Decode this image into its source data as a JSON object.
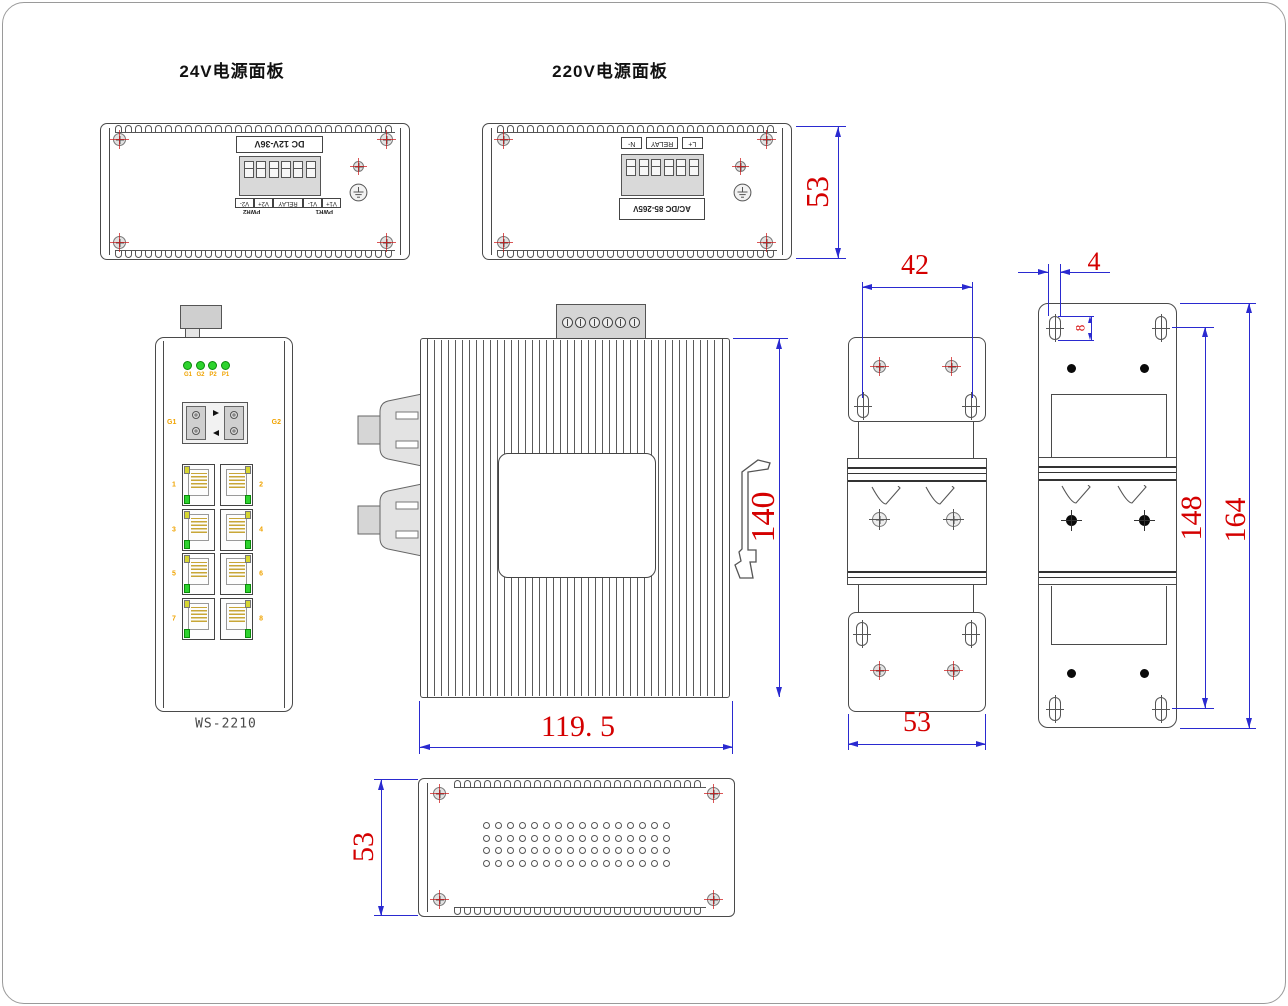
{
  "titles": {
    "panel24": "24V电源面板",
    "panel220": "220V电源面板"
  },
  "panel24": {
    "board_label": "DC 12V-36V",
    "terms": [
      "V1+",
      "V1-",
      "RELAY",
      "V2+",
      "V2-"
    ],
    "pwr_first": "PWR1",
    "pwr_second": "PWR2"
  },
  "panel220": {
    "board_label": "AC/DC 85-265V",
    "terms": [
      "L+",
      "RELAY",
      "N-"
    ]
  },
  "front": {
    "led_labels": [
      "G1",
      "G2",
      "P2",
      "P1"
    ],
    "fiber_left": "G1",
    "fiber_right": "G2",
    "port_numbers": [
      "1",
      "2",
      "3",
      "4",
      "5",
      "6",
      "7",
      "8"
    ],
    "model": "WS-2210"
  },
  "dims": {
    "panel_height": "53",
    "body_height": "140",
    "body_width": "119. 5",
    "slot_span": "42",
    "bracket_width": "53",
    "slot_offset": "4",
    "slot_length": "8",
    "hole_span": "148",
    "bracket_height": "164",
    "depth": "53"
  },
  "colors": {
    "dim_line": "#2a2ad0",
    "dim_text": "#d40000",
    "outline": "#4a4a4a",
    "led_green": "#2ed32e",
    "led_yellow": "#d6d632",
    "label_orange": "#f0a300"
  }
}
